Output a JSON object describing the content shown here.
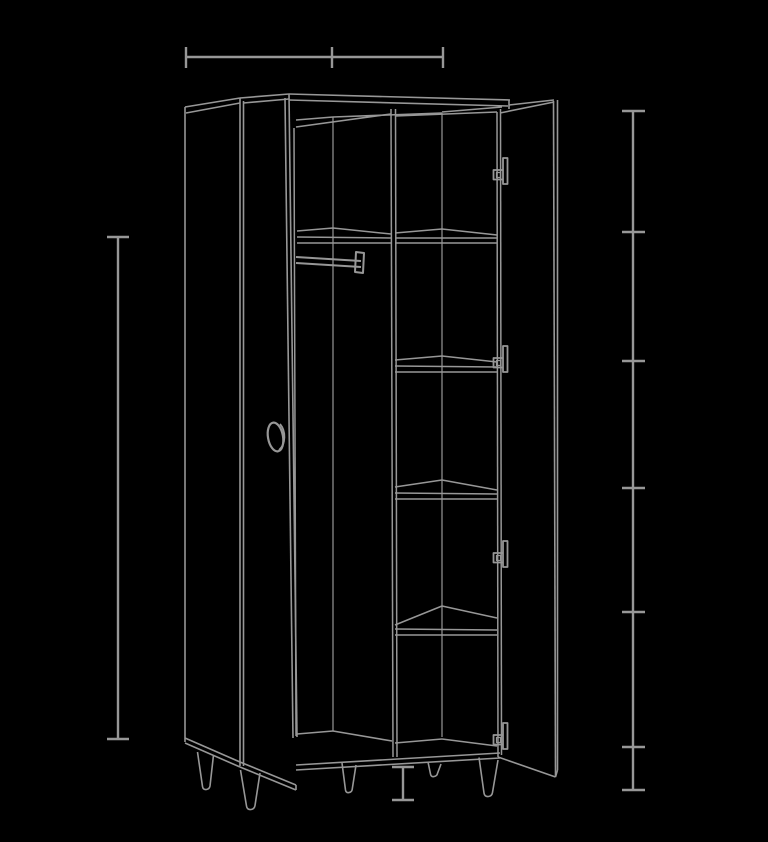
{
  "canvas": {
    "width": 768,
    "height": 842,
    "background": "#000000",
    "line_color": "#979797"
  },
  "scene": {
    "object": "two-door wardrobe",
    "view": "perspective wireframe line drawing",
    "description": "Outline drawing of a wardrobe with both doors open: left compartment with clothes rail and round knob on the door, right compartment with four shelves and a tall top section, five tapered legs, drawn light gray on black.",
    "text_labels": [],
    "parts": [
      "left door",
      "left side panel",
      "carcass top",
      "center divider",
      "clothes rail",
      "right compartment shelves",
      "right door",
      "door edge handles",
      "tapered legs",
      "base panel"
    ]
  },
  "annotations": {
    "top_width_dimension": {
      "labeled": false,
      "tick_count": 3,
      "orientation": "horizontal"
    },
    "left_height_dimension": {
      "labeled": false,
      "tick_count": 2,
      "orientation": "vertical"
    },
    "right_shelf_scale": {
      "labeled": false,
      "tick_count": 7,
      "orientation": "vertical"
    },
    "leg_height_dimension": {
      "labeled": false,
      "tick_count": 2,
      "orientation": "vertical"
    }
  },
  "drawing": {
    "groups": [
      {
        "name": "dimension-top-width",
        "w": 2.4,
        "els": [
          {
            "t": "l",
            "p": [
              186,
              57,
              443,
              57
            ]
          },
          {
            "t": "l",
            "p": [
              186,
              47,
              186,
              68
            ]
          },
          {
            "t": "l",
            "p": [
              332,
              47,
              332,
              68
            ]
          },
          {
            "t": "l",
            "p": [
              443,
              47,
              443,
              68
            ]
          }
        ]
      },
      {
        "name": "dimension-left-height",
        "w": 2.4,
        "els": [
          {
            "t": "l",
            "p": [
              118,
              237,
              118,
              739
            ]
          },
          {
            "t": "l",
            "p": [
              107,
              237,
              129,
              237
            ]
          },
          {
            "t": "l",
            "p": [
              107,
              739,
              129,
              739
            ]
          }
        ]
      },
      {
        "name": "dimension-right-scale",
        "w": 2.4,
        "els": [
          {
            "t": "l",
            "p": [
              633,
              111,
              633,
              790
            ]
          },
          {
            "t": "l",
            "p": [
              622,
              111,
              645,
              111
            ]
          },
          {
            "t": "l",
            "p": [
              622,
              232,
              645,
              232
            ]
          },
          {
            "t": "l",
            "p": [
              622,
              361,
              645,
              361
            ]
          },
          {
            "t": "l",
            "p": [
              622,
              488,
              645,
              488
            ]
          },
          {
            "t": "l",
            "p": [
              622,
              612,
              645,
              612
            ]
          },
          {
            "t": "l",
            "p": [
              622,
              747,
              645,
              747
            ]
          },
          {
            "t": "l",
            "p": [
              622,
              790,
              645,
              790
            ]
          }
        ]
      },
      {
        "name": "dimension-leg-height",
        "w": 2.4,
        "els": [
          {
            "t": "l",
            "p": [
              403,
              767,
              403,
              800
            ]
          },
          {
            "t": "l",
            "p": [
              392,
              767,
              414,
              767
            ]
          },
          {
            "t": "l",
            "p": [
              392,
              800,
              414,
              800
            ]
          }
        ]
      },
      {
        "name": "left-side-and-door",
        "w": 1.6,
        "els": [
          {
            "t": "l",
            "p": [
              185,
              107,
              185,
              742
            ]
          },
          {
            "t": "l",
            "p": [
              185,
              107,
              240,
              98
            ]
          },
          {
            "t": "l",
            "p": [
              186,
              113,
              240,
              103
            ]
          },
          {
            "t": "l",
            "p": [
              240,
              98,
              240,
              766
            ]
          },
          {
            "t": "l",
            "p": [
              243.5,
              101,
              243.5,
              766
            ]
          },
          {
            "t": "l",
            "p": [
              240,
              98,
              289,
              94
            ]
          },
          {
            "t": "l",
            "p": [
              243.5,
              103,
              289,
              99
            ]
          },
          {
            "t": "l",
            "p": [
              289,
              94,
              297,
              737
            ]
          },
          {
            "t": "l",
            "p": [
              285,
              98,
              293,
              738
            ]
          },
          {
            "t": "l",
            "p": [
              185,
              738,
              240,
              762
            ]
          },
          {
            "t": "l",
            "p": [
              185,
              743,
              240,
              767
            ]
          },
          {
            "t": "l",
            "p": [
              240,
              762,
              296,
              785
            ]
          },
          {
            "t": "l",
            "p": [
              240,
              767,
              296,
              790
            ]
          },
          {
            "t": "l",
            "p": [
              296,
              785,
              296,
              790
            ]
          }
        ]
      },
      {
        "name": "door-knob",
        "w": 2.2,
        "els": [
          {
            "t": "e",
            "cx": 275.5,
            "cy": 437,
            "rx": 7.5,
            "ry": 14.5,
            "rot": -10
          },
          {
            "t": "p",
            "d": "M280,424 C286,431 286,444 279,450",
            "w": 1.8
          }
        ]
      },
      {
        "name": "carcass-top",
        "w": 1.6,
        "els": [
          {
            "t": "l",
            "p": [
              289,
              94,
              510,
              100
            ]
          },
          {
            "t": "l",
            "p": [
              289,
              100,
              508,
              106
            ]
          },
          {
            "t": "l",
            "p": [
              509,
              100,
              509,
              109
            ]
          },
          {
            "t": "l",
            "p": [
              296,
              127,
              391,
              114
            ]
          },
          {
            "t": "l",
            "p": [
              296,
              120,
              333,
              117
            ]
          },
          {
            "t": "l",
            "p": [
              333,
              117,
              442,
              113
            ]
          },
          {
            "t": "l",
            "p": [
              395,
              116,
              497,
              112
            ]
          },
          {
            "t": "l",
            "p": [
              442,
              112,
              502,
              107
            ]
          }
        ]
      },
      {
        "name": "interior-verticals",
        "w": 1.5,
        "els": [
          {
            "t": "l",
            "p": [
              294,
              128,
              296,
              736
            ]
          },
          {
            "t": "l",
            "p": [
              333,
              117,
              333,
              731
            ],
            "w": 1.2
          },
          {
            "t": "l",
            "p": [
              391,
              109,
              393,
              757
            ]
          },
          {
            "t": "l",
            "p": [
              395.5,
              109,
              397,
              757
            ]
          },
          {
            "t": "l",
            "p": [
              442,
              113,
              442,
              737
            ],
            "w": 1.2
          },
          {
            "t": "l",
            "p": [
              497,
              112,
              498,
              757
            ]
          },
          {
            "t": "l",
            "p": [
              500.5,
              109,
              501.5,
              755
            ]
          }
        ]
      },
      {
        "name": "clothes-rail",
        "w": 2,
        "els": [
          {
            "t": "l",
            "p": [
              296,
              257,
              361,
              261
            ]
          },
          {
            "t": "l",
            "p": [
              296,
              263,
              361,
              267
            ]
          },
          {
            "t": "p",
            "d": "M356,252 L364,253 L363,273 L355,272 Z"
          }
        ]
      },
      {
        "name": "shelf-top-left",
        "w": 1.5,
        "els": [
          {
            "t": "pl",
            "p": [
              297,
              231,
              333,
              228,
              391,
              234
            ]
          },
          {
            "t": "l",
            "p": [
              297,
              237,
              391,
              238
            ]
          },
          {
            "t": "l",
            "p": [
              297,
              243,
              391,
              243
            ]
          }
        ]
      },
      {
        "name": "shelf-1",
        "w": 1.5,
        "els": [
          {
            "t": "pl",
            "p": [
              395,
              233,
              442,
              229,
              497,
              235
            ]
          },
          {
            "t": "l",
            "p": [
              395,
              238,
              497,
              238
            ]
          },
          {
            "t": "l",
            "p": [
              395,
              243,
              497,
              243
            ]
          }
        ]
      },
      {
        "name": "shelf-2",
        "w": 1.5,
        "els": [
          {
            "t": "pl",
            "p": [
              395,
              360,
              442,
              356,
              497,
              362
            ]
          },
          {
            "t": "l",
            "p": [
              395,
              366,
              497,
              367
            ]
          },
          {
            "t": "l",
            "p": [
              395,
              372,
              497,
              372
            ]
          }
        ]
      },
      {
        "name": "shelf-3",
        "w": 1.5,
        "els": [
          {
            "t": "pl",
            "p": [
              395,
              487,
              442,
              480,
              497,
              490
            ]
          },
          {
            "t": "l",
            "p": [
              395,
              493,
              497,
              494
            ]
          },
          {
            "t": "l",
            "p": [
              395,
              499,
              497,
              499
            ]
          }
        ]
      },
      {
        "name": "shelf-4",
        "w": 1.5,
        "els": [
          {
            "t": "pl",
            "p": [
              395,
              625,
              442,
              606,
              497,
              618
            ]
          },
          {
            "t": "l",
            "p": [
              395,
              629,
              497,
              630
            ]
          },
          {
            "t": "l",
            "p": [
              395,
              635,
              497,
              635
            ]
          }
        ]
      },
      {
        "name": "base-and-floor",
        "w": 1.6,
        "els": [
          {
            "t": "l",
            "p": [
              297,
              734,
              333,
              731
            ]
          },
          {
            "t": "l",
            "p": [
              333,
              731,
              392,
              741
            ]
          },
          {
            "t": "l",
            "p": [
              395,
              743,
              442,
              739
            ]
          },
          {
            "t": "l",
            "p": [
              442,
              739,
              497,
              746
            ]
          },
          {
            "t": "l",
            "p": [
              296,
              765,
              500,
              753
            ]
          },
          {
            "t": "l",
            "p": [
              296,
              770,
              500,
              758
            ]
          }
        ]
      },
      {
        "name": "right-door",
        "w": 1.6,
        "els": [
          {
            "t": "l",
            "p": [
              500,
              113,
              554,
              102
            ]
          },
          {
            "t": "l",
            "p": [
              509,
              105,
              554,
              100
            ]
          },
          {
            "t": "l",
            "p": [
              553.5,
              101,
              555.5,
              776
            ]
          },
          {
            "t": "l",
            "p": [
              557.5,
              100,
              557.5,
              770
            ]
          },
          {
            "t": "l",
            "p": [
              498,
              757,
              555.5,
              777
            ]
          },
          {
            "t": "l",
            "p": [
              555.5,
              777,
              557.5,
              770
            ]
          }
        ]
      },
      {
        "name": "door-handle-1",
        "w": 1.8,
        "els": [
          {
            "t": "p",
            "d": "M503,158 h4.5 v26 h-4.5 Z"
          },
          {
            "t": "p",
            "d": "M503,170 h-9.5 v9.5 h9.5"
          },
          {
            "t": "p",
            "d": "M496.5,172.5 h4 v5 h-4 Z",
            "w": 1.2
          }
        ]
      },
      {
        "name": "door-handle-2",
        "w": 1.8,
        "els": [
          {
            "t": "p",
            "d": "M503,346 h4.5 v26 h-4.5 Z"
          },
          {
            "t": "p",
            "d": "M503,358 h-9.5 v9.5 h9.5"
          },
          {
            "t": "p",
            "d": "M496.5,360.5 h4 v5 h-4 Z",
            "w": 1.2
          }
        ]
      },
      {
        "name": "door-handle-3",
        "w": 1.8,
        "els": [
          {
            "t": "p",
            "d": "M503,541 h4.5 v26 h-4.5 Z"
          },
          {
            "t": "p",
            "d": "M503,553 h-9.5 v9.5 h9.5"
          },
          {
            "t": "p",
            "d": "M496.5,555.5 h4 v5 h-4 Z",
            "w": 1.2
          }
        ]
      },
      {
        "name": "door-handle-4",
        "w": 1.8,
        "els": [
          {
            "t": "p",
            "d": "M503,723 h4.5 v26 h-4.5 Z"
          },
          {
            "t": "p",
            "d": "M503,735 h-9.5 v9.5 h9.5"
          },
          {
            "t": "p",
            "d": "M496.5,737.5 h4 v5 h-4 Z",
            "w": 1.2
          }
        ]
      },
      {
        "name": "legs",
        "w": 1.6,
        "els": [
          {
            "t": "p",
            "d": "M197.5,752 L202.5,786.5 Q203,790 206.5,789.5 Q209.5,789 210,786 L213.5,755"
          },
          {
            "t": "p",
            "d": "M240.5,770 L246.5,806 Q247,810 251,809.5 Q254.5,809 255,805.5 L260,773"
          },
          {
            "t": "p",
            "d": "M342,763 L345.5,790 Q346,793 348.8,792.6 Q351.8,792.2 352.2,789.4 L356,765"
          },
          {
            "t": "p",
            "d": "M428,762 L430.5,774 Q431,777 433.8,776.6 Q437,776.2 437.5,773.4 L441,764"
          },
          {
            "t": "p",
            "d": "M479,757.5 L484,793 Q484.5,797 488.5,796.5 Q492,796 492.5,792.5 L498,760"
          }
        ]
      }
    ]
  }
}
